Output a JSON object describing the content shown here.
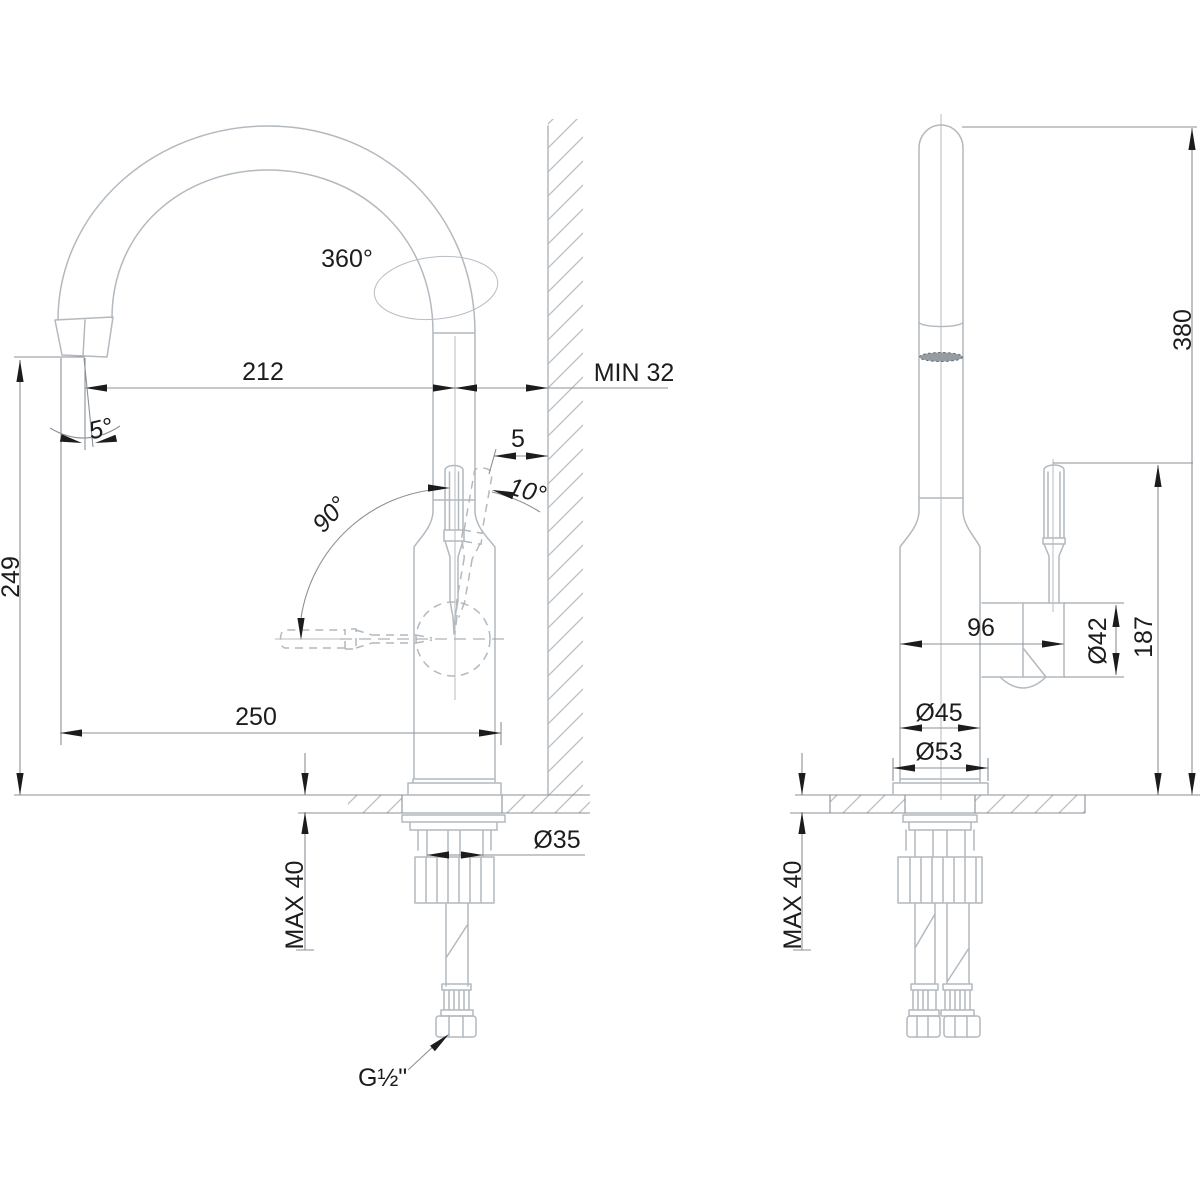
{
  "colors": {
    "background": "#ffffff",
    "ink": "#1c1c1c",
    "outline_gray": "#b2b9bf",
    "dimension_gray": "#8a9197"
  },
  "views": {
    "left": {
      "swivel": "360°",
      "spout_reach": "212",
      "wall_min": "MIN 32",
      "spout_tilt": "5°",
      "spout_height": "249",
      "handle_swing": "90°",
      "handle_tilt": "10°",
      "handle_wall_gap": "5",
      "total_depth": "250",
      "counter_max": "MAX 40",
      "shank_diameter": "Ø35",
      "thread": "G½\""
    },
    "right": {
      "total_height": "380",
      "body_depth": "96",
      "valve_diameter": "Ø42",
      "handle_height": "187",
      "body_diameter": "Ø45",
      "flange_diameter": "Ø53",
      "counter_max": "MAX 40"
    }
  }
}
